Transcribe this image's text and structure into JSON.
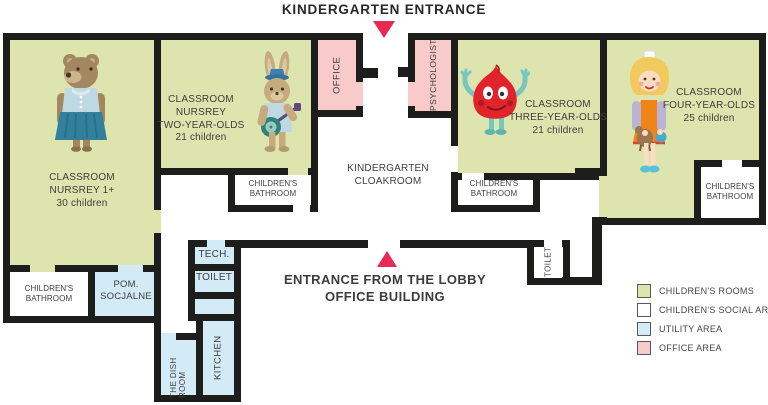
{
  "entrances": {
    "kindergarten": "KINDERGARTEN ENTRANCE",
    "lobby_line1": "ENTRANCE FROM THE LOBBY",
    "lobby_line2": "OFFICE BUILDING"
  },
  "classrooms": {
    "nursery1": {
      "l1": "CLASSROOM",
      "l2": "NURSREY 1+",
      "l3": "30 children"
    },
    "nursery2": {
      "l1": "CLASSROOM",
      "l2": "NURSREY",
      "l3": "TWO-YEAR-OLDS",
      "l4": "21 children"
    },
    "three_year_olds": {
      "l1": "CLASSROOM",
      "l2": "THREE-YEAR-OLDS",
      "l3": "21 children"
    },
    "four_year_olds": {
      "l1": "CLASSROOM",
      "l2": "FOUR-YEAR-OLDS",
      "l3": "25 children"
    }
  },
  "characters": {
    "nursery1": "bear-in-dress",
    "nursery2": "rabbit-playing-banjo",
    "three_year_olds": "red-onion-creature",
    "four_year_olds": "girl-with-toy-horse"
  },
  "rooms": {
    "cloakroom_l1": "KINDERGARTEN",
    "cloakroom_l2": "CLOAKROOM",
    "bathroom_l1": "CHILDREN'S",
    "bathroom_l2": "BATHROOM",
    "pom_l1": "POM.",
    "pom_l2": "SOCJALNE",
    "tech": "TECH.",
    "toilet": "TOILET",
    "office": "OFFICE",
    "psychologist": "PSYCHOLOGIST",
    "dish_room": "THE DISH ROOM",
    "kitchen": "KITCHEN"
  },
  "legend": {
    "items": [
      {
        "label": "CHILDREN'S ROOMS",
        "color": "#dde4ae"
      },
      {
        "label": "CHILDREN'S SOCIAL AREA",
        "color": "#ffffff"
      },
      {
        "label": "UTILITY AREA",
        "color": "#d3eaf7"
      },
      {
        "label": "OFFICE AREA",
        "color": "#f8caca"
      }
    ]
  },
  "colors": {
    "wall": "#1d1d1b",
    "accent_red": "#e92953",
    "children_rooms": "#dde4ae",
    "social_area": "#ffffff",
    "utility_area": "#d3eaf7",
    "office_area": "#f8caca"
  }
}
